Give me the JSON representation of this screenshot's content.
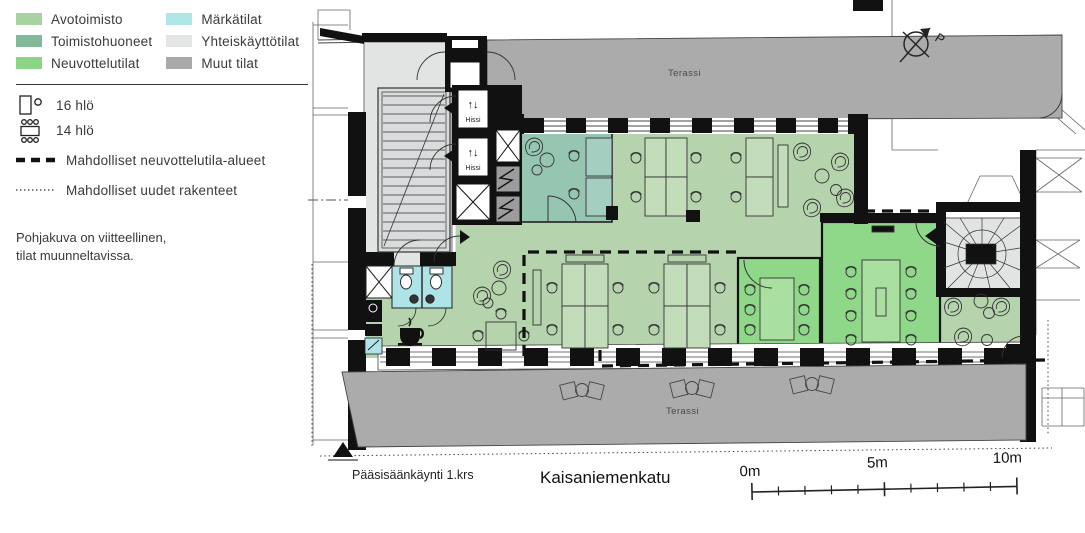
{
  "legend": {
    "area_types": [
      {
        "label": "Avotoimisto",
        "color": "#a9d2a3"
      },
      {
        "label": "Toimistohuoneet",
        "color": "#83b99b"
      },
      {
        "label": "Neuvottelutilat",
        "color": "#8bd586"
      },
      {
        "label": "Märkätilat",
        "color": "#b0e5e8"
      },
      {
        "label": "Yhteiskäyttötilat",
        "color": "#e4e6e6"
      },
      {
        "label": "Muut tilat",
        "color": "#a7a9ab"
      }
    ],
    "capacity": [
      {
        "icon": "desk-chair-icon",
        "label": "16 hlö"
      },
      {
        "icon": "meeting-table-icon",
        "label": "14 hlö"
      }
    ],
    "line_types": [
      {
        "style": "dashed",
        "label": "Mahdolliset neuvottelutila-alueet"
      },
      {
        "style": "dotted",
        "label": "Mahdolliset uudet rakenteet"
      }
    ],
    "disclaimer_line1": "Pohjakuva on viitteellinen,",
    "disclaimer_line2": "tilat muunneltavissa."
  },
  "plan": {
    "room_fills": {
      "avotoimisto": "#b5d3ac",
      "toimistohuoneet": "#96c6b2",
      "neuvottelutilat": "#8fd889",
      "markatilat": "#aee4e8",
      "yhteiskayttotilat": "#e2e4e4",
      "muut": "#ababab"
    },
    "labels": {
      "terassi_top": "Terassi",
      "terassi_bottom": "Terassi",
      "hissi_upper": "Hissi",
      "hissi_lower": "Hissi",
      "compass_north": "P"
    },
    "icons": {
      "elevator_arrows": "↑↓"
    },
    "footer": {
      "entrance": "Pääsisäänkäynti 1.krs",
      "street": "Kaisaniemenkatu"
    },
    "scale_bar": {
      "start": "0m",
      "middle": "5m",
      "end": "10m"
    }
  }
}
